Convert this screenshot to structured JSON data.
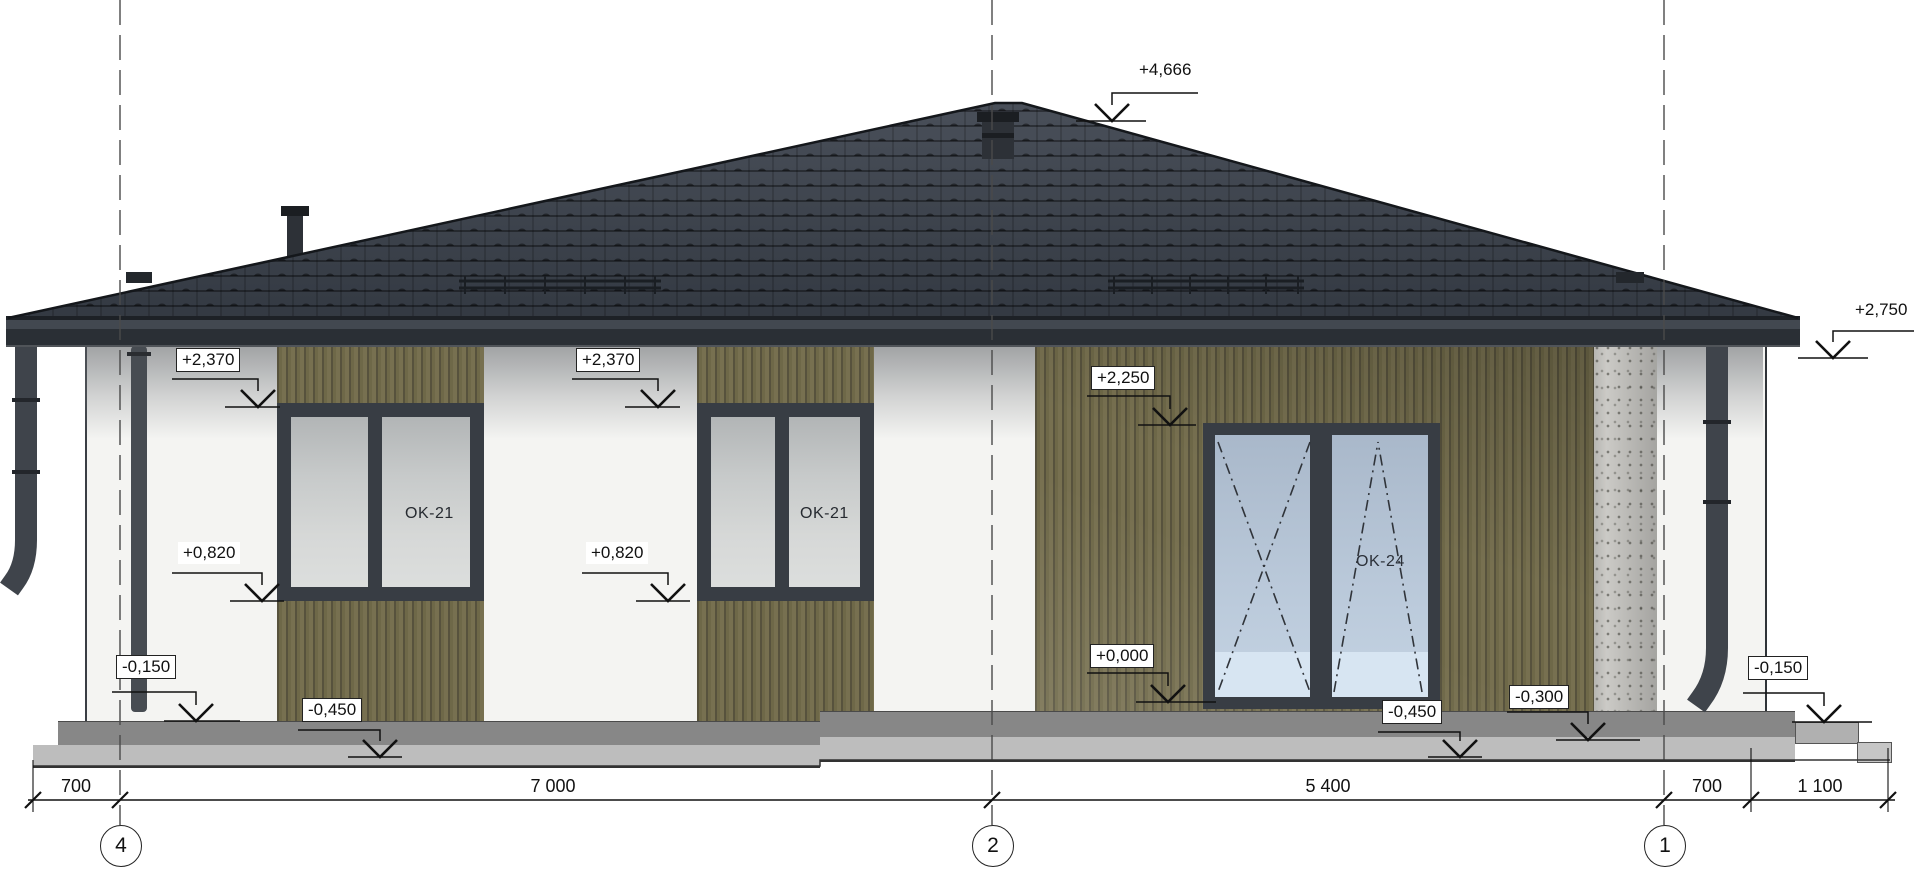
{
  "drawing": {
    "kind": "house-elevation",
    "colors": {
      "roof": "#3b4049",
      "fascia": "#2a2f35",
      "siding": "#6b6547",
      "wall": "#f4f4f2",
      "window_frame": "#383d44",
      "window_glass": "#c7caca",
      "door_glass": "#b9c8d9",
      "concrete_pillar": "#cbcac6",
      "plinth_dark": "#878787",
      "plinth_light": "#bdbdbd",
      "line": "#111111"
    },
    "elevation_marks": [
      {
        "name": "ridge",
        "value": "+4,666"
      },
      {
        "name": "eave-right",
        "value": "+2,750"
      },
      {
        "name": "window-head-left",
        "value": "+2,370"
      },
      {
        "name": "window-head-mid",
        "value": "+2,370"
      },
      {
        "name": "door-head",
        "value": "+2,250"
      },
      {
        "name": "window-sill-left",
        "value": "+0,820"
      },
      {
        "name": "window-sill-mid",
        "value": "+0,820"
      },
      {
        "name": "door-threshold",
        "value": "+0,000"
      },
      {
        "name": "ground-left",
        "value": "-0,150"
      },
      {
        "name": "blind-area-left",
        "value": "-0,450"
      },
      {
        "name": "blind-area-right",
        "value": "-0,450"
      },
      {
        "name": "porch-step",
        "value": "-0,300"
      },
      {
        "name": "ground-right",
        "value": "-0,150"
      }
    ],
    "openings": [
      {
        "label": "OK-21"
      },
      {
        "label": "OK-21"
      },
      {
        "label": "OK-24"
      }
    ],
    "dimensions": {
      "segments": [
        "700",
        "7 000",
        "5 400",
        "700",
        "1 100"
      ]
    },
    "axes": [
      {
        "label": "4"
      },
      {
        "label": "2"
      },
      {
        "label": "1"
      }
    ]
  }
}
